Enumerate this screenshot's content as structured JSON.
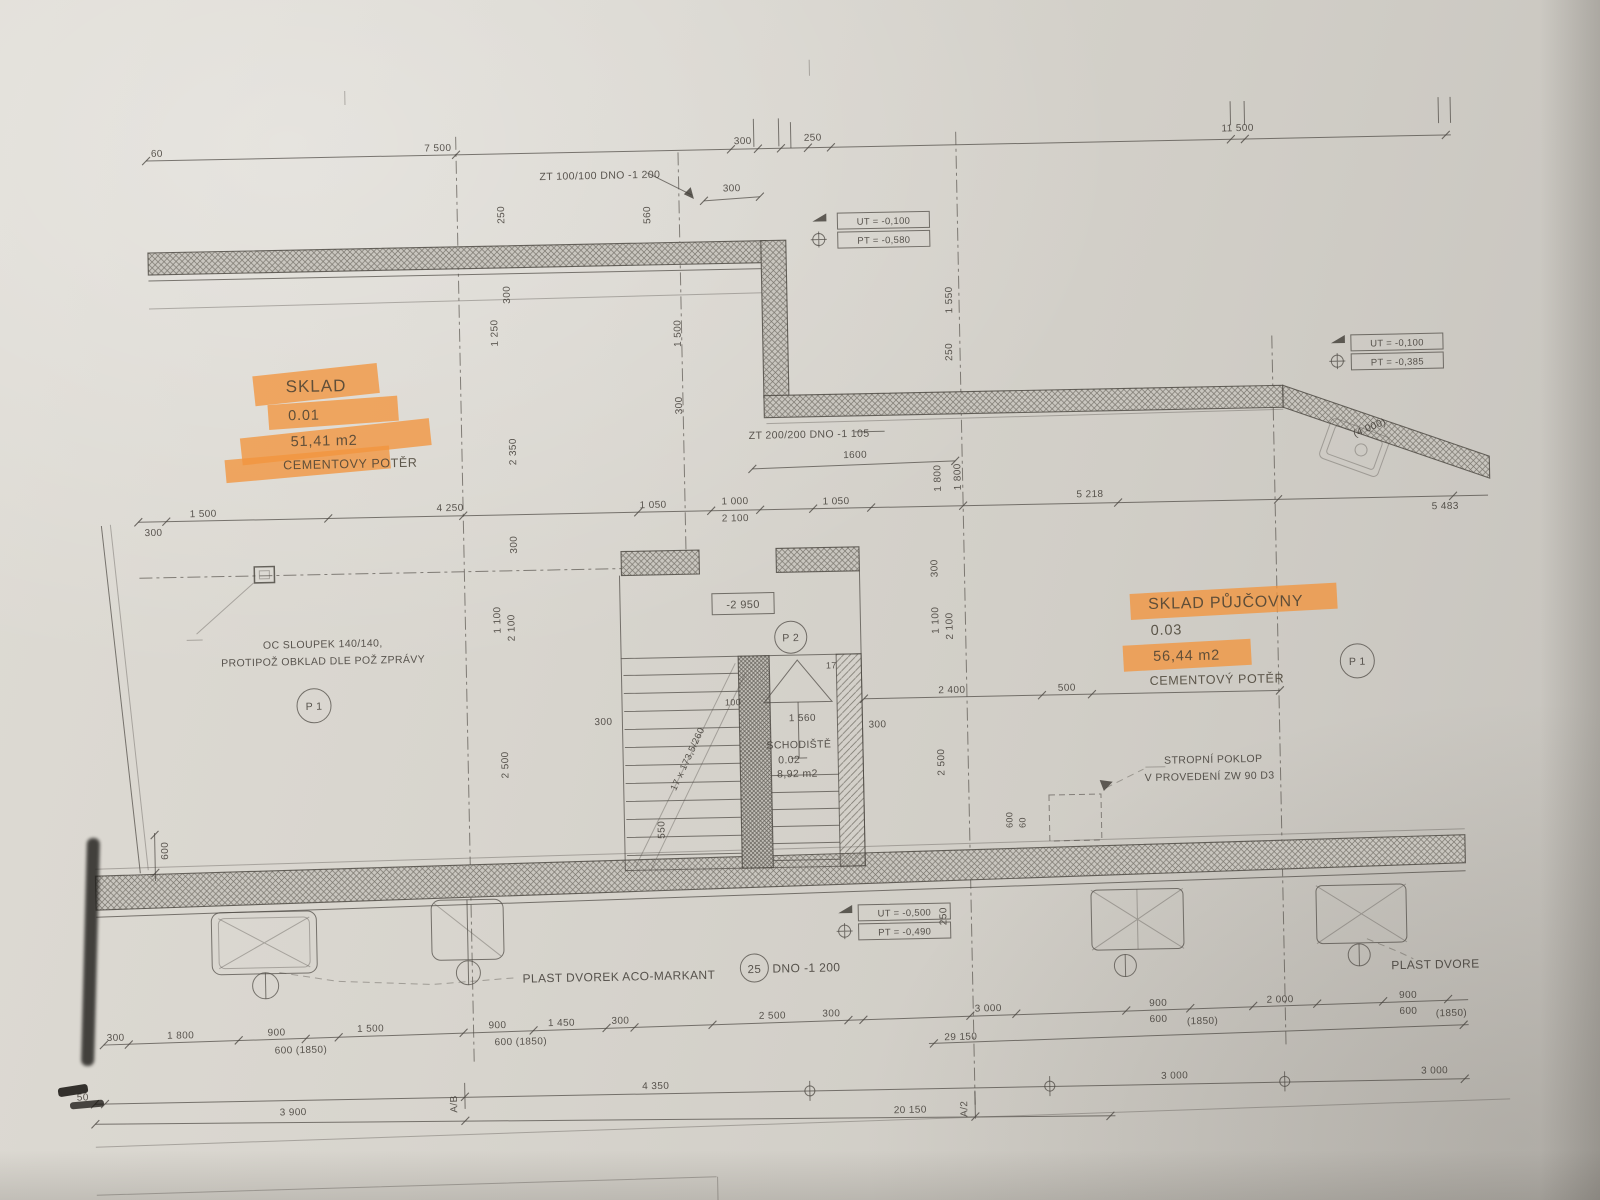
{
  "rooms": [
    {
      "name": "SKLAD",
      "number": "0.01",
      "area": "51,41 m2",
      "floor": "CEMENTOVY POTĚR"
    },
    {
      "name": "SCHODIŠTĚ",
      "number": "0.02",
      "area": "8,92 m2"
    },
    {
      "name": "SKLAD PŮJČOVNY",
      "number": "0.03",
      "area": "56,44 m2",
      "floor": "CEMENTOVÝ POTĚR"
    }
  ],
  "marks": {
    "p1": "P 1",
    "p2": "P 2",
    "ref25": "25",
    "axis_ab": "A/B",
    "axis_a2": "A/2",
    "level_box": "-2 950",
    "risers": "17"
  },
  "notes": {
    "zt_top": "ZT 100/100 DNO -1 200",
    "zt_mid": "ZT 200/200 DNO -1 105",
    "column_line1": "OC SLOUPEK 140/140,",
    "column_line2": "PROTIPOŽ OBKLAD DLE POŽ ZPRÁVY",
    "poklop_line1": "STROPNÍ POKLOP",
    "poklop_line2": "V PROVEDENÍ ZW 90 D3",
    "drain_left": "PLAST DVOREK ACO-MARKANT",
    "drain_dno": "DNO -1 200",
    "drain_right": "PLAST DVORE",
    "stair_formula": "17 x 173,5/260"
  },
  "levels": {
    "top_ut": "UT = -0,100",
    "top_pt": "PT = -0,580",
    "right_ut": "UT = -0,100",
    "right_pt": "PT = -0,385",
    "bottom_ut": "UT = -0,500",
    "bottom_pt": "PT = -0,490"
  },
  "dims": {
    "top": [
      "60",
      "7 500",
      "300",
      "250",
      "300",
      "11 500"
    ],
    "upper_v": [
      "250",
      "560",
      "300",
      "1 250",
      "1 500",
      "300",
      "1 550",
      "250",
      "2 350",
      "1 800",
      "(4 000)"
    ],
    "mid": [
      "300",
      "1 500",
      "4 250",
      "1 050",
      "1 000",
      "2 100",
      "1 050",
      "5 218",
      "5 483",
      "1600",
      "1 800"
    ],
    "grid_v": [
      "300",
      "1 100",
      "2 100",
      "2 500",
      "550",
      "300",
      "1 100",
      "2 100",
      "2 500",
      "250",
      "600",
      "60",
      "600"
    ],
    "stair": [
      "300",
      "100",
      "1 560",
      "300",
      "2 400",
      "500"
    ],
    "bottom1": [
      "300",
      "1 800",
      "900",
      "600 (1850)",
      "1 500",
      "900",
      "600 (1850)",
      "1 450",
      "300",
      "2 500",
      "300",
      "3 000",
      "900",
      "600",
      "(1850)",
      "2 000",
      "900",
      "600",
      "(1850)",
      "29 150"
    ],
    "bottom2": [
      "3 900",
      "4 350",
      "3 000",
      "3 000",
      "20 150",
      "50"
    ]
  },
  "colors": {
    "highlight": "#f2953e",
    "ink": "#413d37",
    "paper": "#d4d1ca"
  }
}
